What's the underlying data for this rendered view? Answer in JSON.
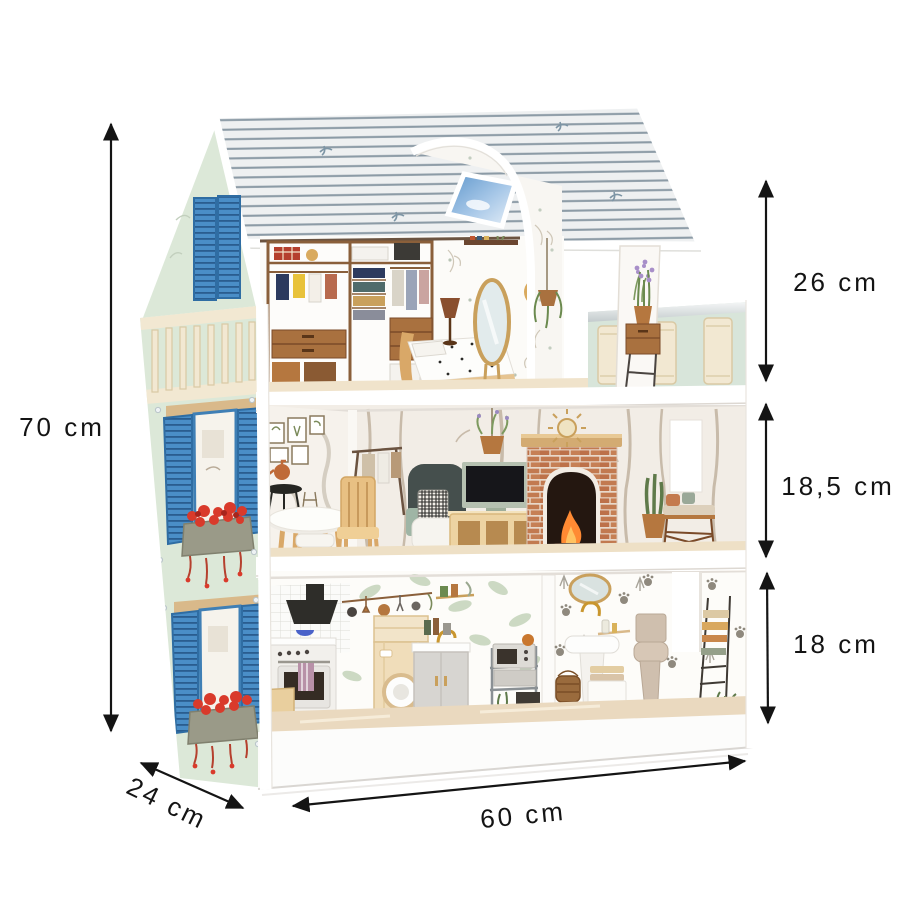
{
  "meta": {
    "type": "product-dimensions-diagram",
    "subject": "three-storey wooden dollhouse with furniture"
  },
  "dimensions": {
    "height": {
      "label": "70 cm",
      "side": "left"
    },
    "width": {
      "label": "60 cm",
      "side": "bottom"
    },
    "depth": {
      "label": "24 cm",
      "side": "bottom-left"
    },
    "floor_heights": [
      {
        "floor": "top (attic bedroom)",
        "label": "26 cm"
      },
      {
        "floor": "middle (living room)",
        "label": "18,5 cm"
      },
      {
        "floor": "ground (kitchen & bath)",
        "label": "18 cm"
      }
    ]
  },
  "palette": {
    "background": "#ffffff",
    "dimension_lines": "#141414",
    "roof_base": "#eef0f1",
    "roof_stripe": "#8c9ba6",
    "wall_mint": "#dce8d8",
    "shutter_blue": "#4a8ec7",
    "flowers_red": "#d93a2b",
    "wood_light": "#e6c491",
    "wood_brown": "#a9713f",
    "brick": "#c27a50",
    "balcony_cream": "#f2e8d2",
    "sky_window": "#6fa7d8"
  }
}
